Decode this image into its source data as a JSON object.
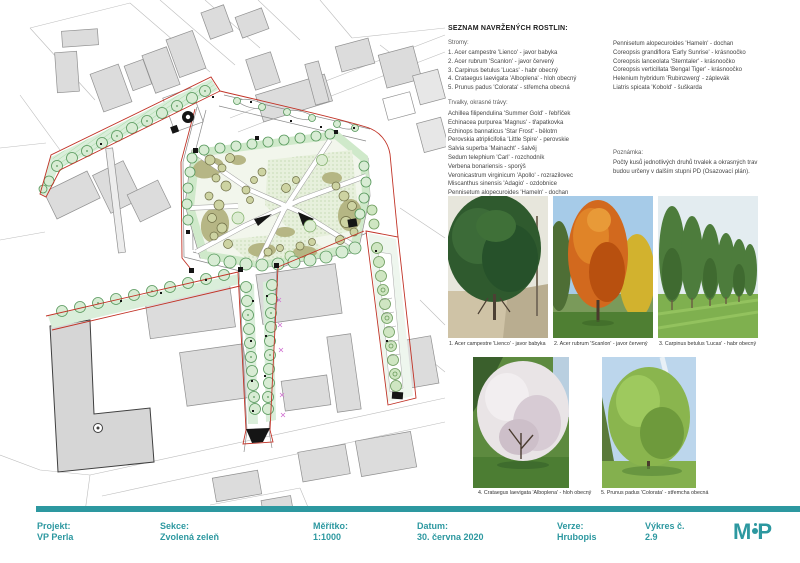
{
  "plant_list": {
    "title": "SEZNAM NAVRŽENÝCH ROSTLIN:",
    "trees_heading": "Stromy:",
    "trees": [
      "1. Acer campestre 'Lienco' - javor babyka",
      "2. Acer rubrum 'Scanlon' - javor červený",
      "3. Carpinus betulus 'Lucas' - habr obecný",
      "4. Crataegus laevigata 'Alboplena' - hloh obecný",
      "5. Prunus padus 'Colorata' - střemcha obecná"
    ],
    "perennials_heading": "Trvalky, okrasné trávy:",
    "perennials_col1": [
      "Achillea filipendulina 'Summer Gold' - řebříček",
      "Echinacea purpurea 'Magnus' - třapatkovka",
      "Echinops bannaticus 'Star Frost' - bělotrn",
      "Perovskia atriplicifolia 'Little Spire' - perovskie",
      "Salvia superba 'Mainacht' - šalvěj",
      "Sedum telephium 'Carl' - rozchodník",
      "Verbena bonariensis - sporýš",
      "Veronicastrum virginicum 'Apollo' - rozrazilovec",
      "Miscanthus sinensis 'Adagio' - ozdobnice",
      "Pennisetum alopecuroides 'Hameln' - dochan"
    ],
    "perennials_col2": [
      "Pennisetum alopecuroides 'Hameln' - dochan",
      "Coreopsis grandiflora 'Early Sunrise' - krásnoočko",
      "Coreopsis lanceolata 'Sterntaler' - krásnoočko",
      "Coreopsis verticillata 'Bengal Tiger' - krásnoočko",
      "Helenium hybridum 'Rubinzwerg' - záplevák",
      "Liatris spicata 'Kobold' - šuškarda"
    ],
    "note_heading": "Poznámka:",
    "note_lines": [
      "Počty kusů jednotlivých druhů trvalek a okrasných trav",
      "budou určeny v dalším stupni PD (Osazovací plán)."
    ]
  },
  "photo_captions": [
    "1. Acer campestre 'Lienco' - javor babyka",
    "2. Acer rubrum 'Scanlon' - javor červený",
    "3. Carpinus betulus 'Lucas' - habr obecný",
    "4. Crataegus laevigata 'Alboplena' - hloh obecný",
    "5. Prunus padus 'Colorata' - střemcha obecná"
  ],
  "footer": {
    "fields": [
      {
        "label": "Projekt:",
        "value": "VP Perla"
      },
      {
        "label": "Sekce:",
        "value": "Zvolená zeleň"
      },
      {
        "label": "Měřítko:",
        "value": "1:1000"
      },
      {
        "label": "Datum:",
        "value": "30. června 2020"
      },
      {
        "label": "Verze:",
        "value": "Hrubopis"
      },
      {
        "label": "Výkres č.",
        "value": "2.9"
      }
    ],
    "logo_m": "M",
    "logo_p": "P"
  },
  "colors": {
    "accent_teal": "#2d98a0",
    "boundary_red": "#c13327",
    "strip_green": "#daeeda",
    "tree_stroke_green": "#55975a",
    "building_gray": "#dcdcdc"
  }
}
